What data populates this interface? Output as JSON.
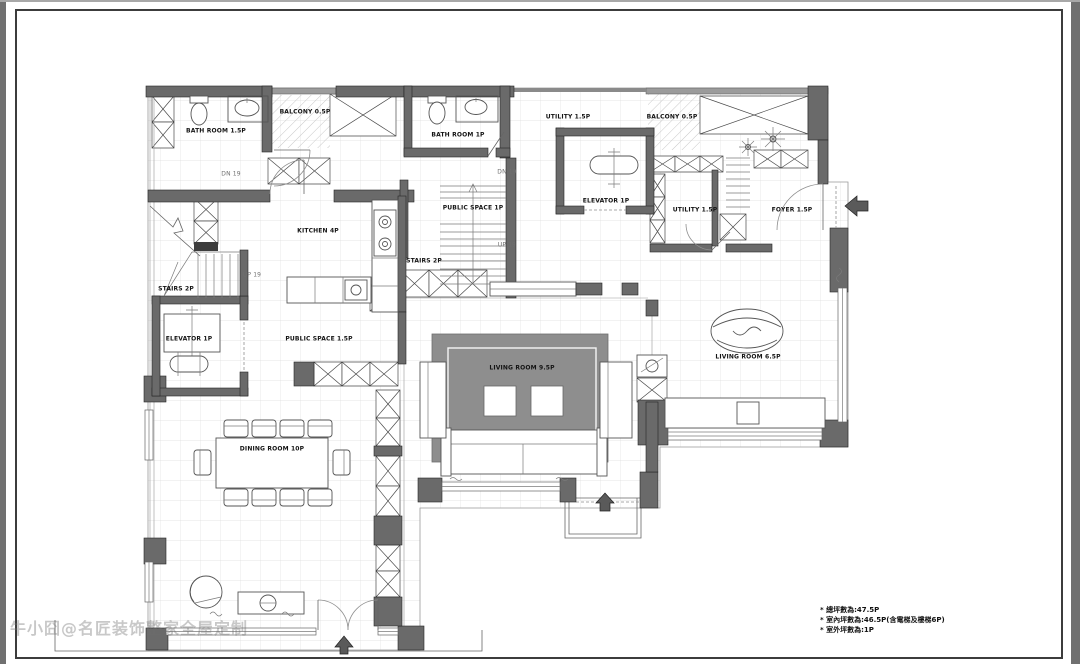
{
  "sheet": {
    "type": "floor-plan"
  },
  "colors": {
    "wall": "#6a6a6a",
    "rug": "#8e8e8e",
    "grid": "#dedede",
    "paper": "#ffffff",
    "edge": "#707070"
  },
  "rooms": [
    {
      "label": "BATH ROOM 1.5P"
    },
    {
      "label": "BALCONY 0.5P"
    },
    {
      "label": "BATH ROOM 1P"
    },
    {
      "label": "UTILITY 1.5P"
    },
    {
      "label": "BALCONY 0.5P"
    },
    {
      "label": "ELEVATOR 1P"
    },
    {
      "label": "UTILITY 1.5P"
    },
    {
      "label": "FOYER 1.5P"
    },
    {
      "label": "KITCHEN 4P"
    },
    {
      "label": "PUBLIC SPACE 1P"
    },
    {
      "label": "STAIRS 2P"
    },
    {
      "label": "STAIRS 2P"
    },
    {
      "label": "ELEVATOR 1P"
    },
    {
      "label": "PUBLIC SPACE 1.5P"
    },
    {
      "label": "LIVING ROOM 9.5P"
    },
    {
      "label": "LIVING ROOM 6.5P"
    },
    {
      "label": "DINING ROOM 10P"
    }
  ],
  "annotations": {
    "dn_left": "DN 19",
    "up_left": "UP 19",
    "dn_mid": "DN 19",
    "up_mid": "UP 19"
  },
  "notes": [
    "* 總坪數為:47.5P",
    "* 室內坪數為:46.5P(含電梯及樓梯6P)",
    "* 室外坪數為:1P"
  ],
  "watermark": "牛小囧@名匠装饰整家全屋定制"
}
